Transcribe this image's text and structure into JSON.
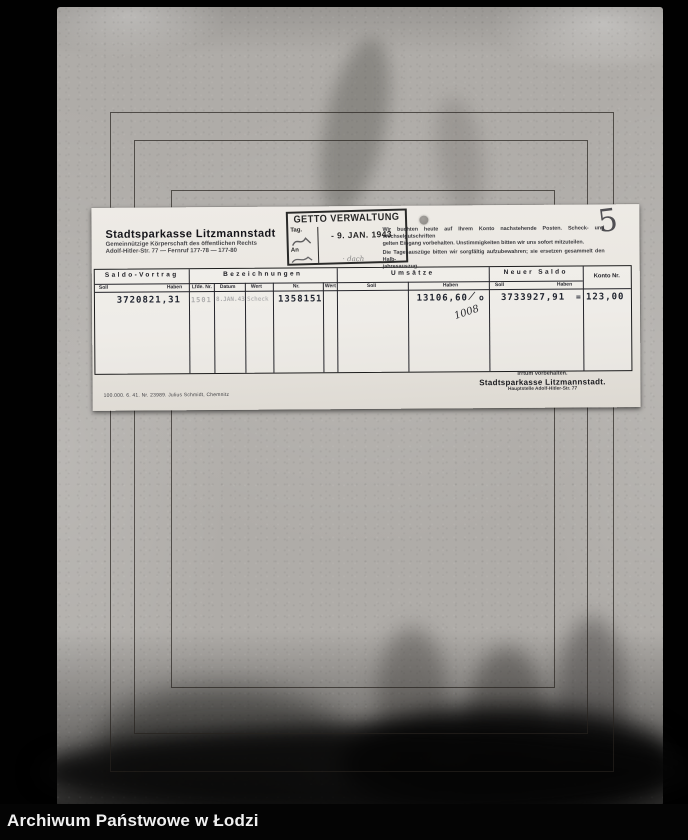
{
  "photo": {
    "archive_label": "Archiwum Państwowe w Łodzi",
    "page_number": "5"
  },
  "card": {
    "header": {
      "name": "Stadtsparkasse Litzmannstadt",
      "line2": "Gemeinnützige Körperschaft des öffentlichen Rechts",
      "line3": "Adolf-Hitler-Str. 77  —  Fernruf 177-78 — 177-80"
    },
    "stamp": {
      "title": "GETTO VERWALTUNG",
      "date": "- 9. JAN. 1943",
      "left_top": "Tag.",
      "left_bottom": "An",
      "note_below": "· dach"
    },
    "notice": {
      "line1": "Wir buchten heute auf Ihrem Konto nachstehende Posten. Scheck- und Wechselgutschriften",
      "line2": "gelten Eingang vorbehalten. Unstimmigkeiten bitten wir uns sofort mitzuteilen.",
      "line3": "Die Tagesauszüge bitten wir sorgfältig aufzubewahren; sie ersetzen gesammelt den Halb-",
      "line4": "jahresauszug."
    },
    "table": {
      "sections": {
        "saldo_vortrag": "Saldo-Vortrag",
        "bezeichnungen": "Bezeichnungen",
        "umsaetze": "Umsätze",
        "neuer_saldo": "Neuer Saldo",
        "konto_nr": "Konto Nr."
      },
      "sub": {
        "soll": "Soll",
        "haben": "Haben",
        "lfde_nr": "Lfde. Nr.",
        "datum": "Datum",
        "wert": "Wert",
        "nr": "Nr."
      },
      "row": {
        "saldo_vortrag_haben": "3720821,31",
        "lfde_nr": "1501",
        "datum": "8.JAN.43",
        "wert": "Scheck",
        "nr": "135815",
        "wert2": "1",
        "umsaetze_haben": "13106,60",
        "slash_mark": "/",
        "circle_mark": "o",
        "handwritten_note": "1008",
        "neuer_saldo_haben": "3733927,91",
        "equals_mark": "=",
        "konto_nr": "123,00"
      }
    },
    "footer": {
      "imprint": "100.000. 6. 41. Nr. 23989. Julius Schmidt, Chemnitz",
      "errors_note": "Irrtum vorbehalten.",
      "bank_name": "Stadtsparkasse Litzmannstadt.",
      "branch": "Hauptstelle Adolf-Hitler-Str. 77"
    }
  }
}
